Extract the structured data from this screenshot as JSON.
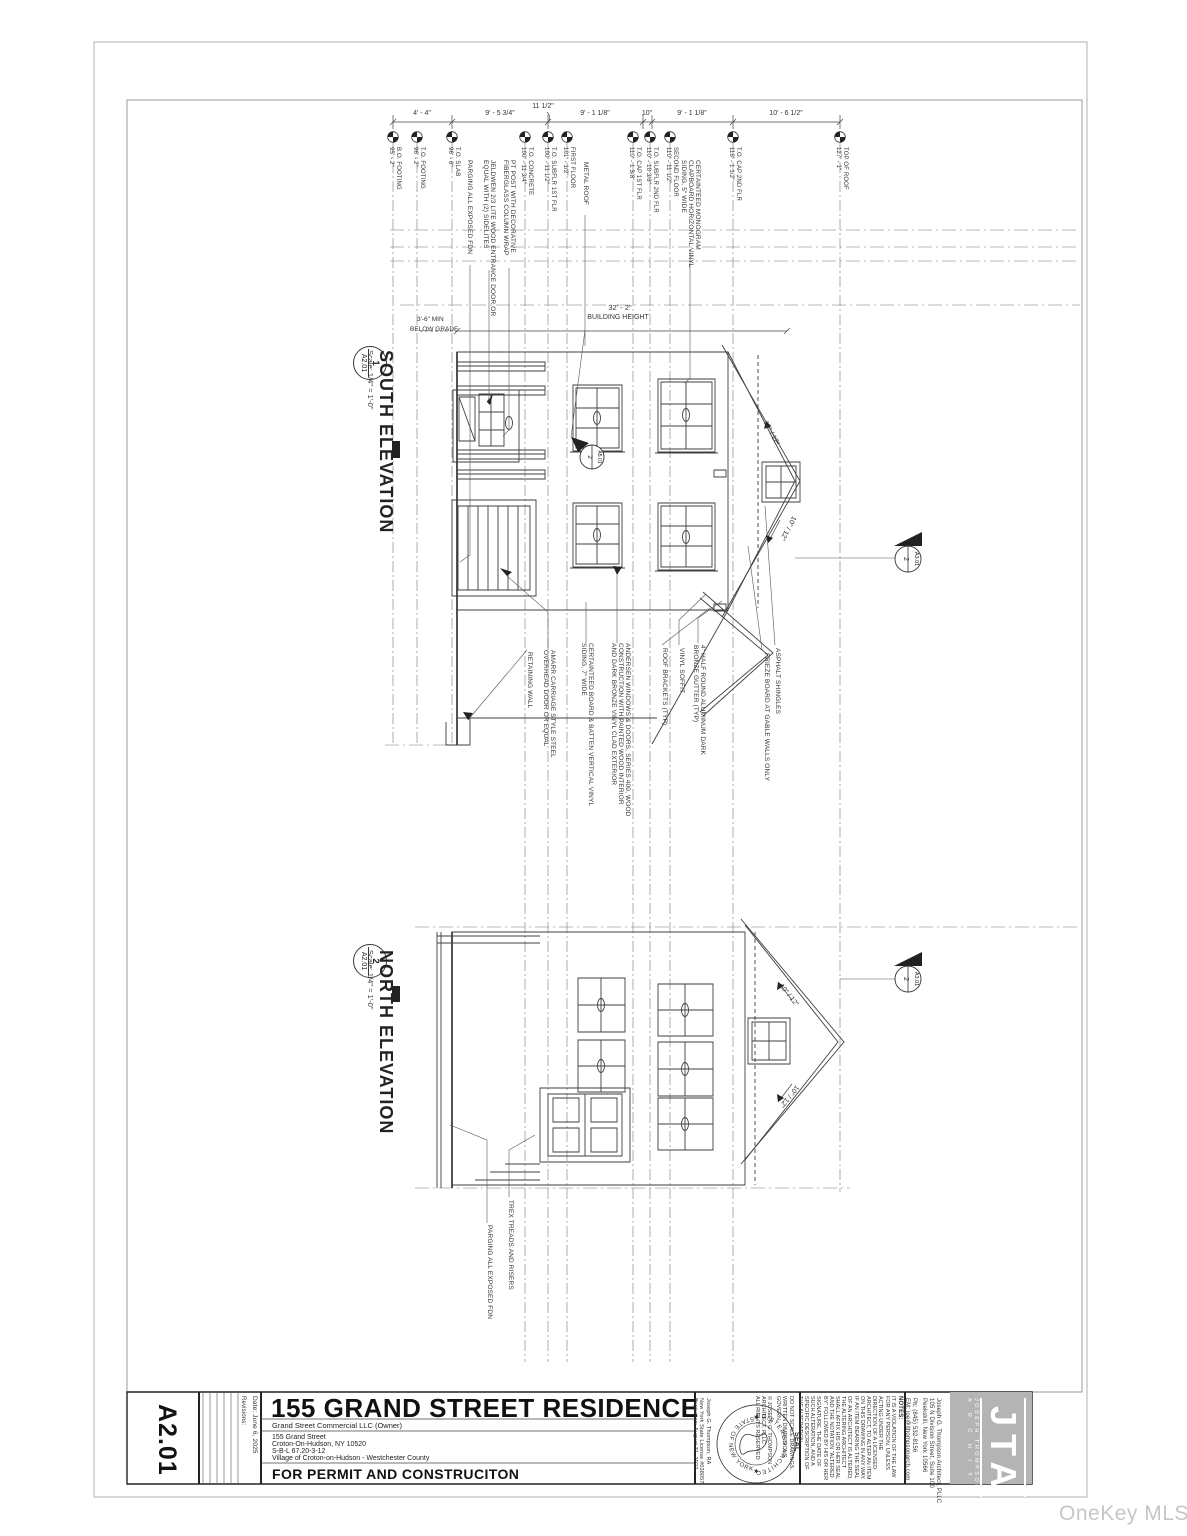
{
  "watermark": "OneKey MLS",
  "titleblock": {
    "sheet_number": "A2.01",
    "revisions_label": "Revisions:",
    "date_line": "Date: June 6, 2025",
    "project_title": "155 GRAND STREET RESIDENCE",
    "owner_line": "Grand Street Commercial LLC (Owner)",
    "address_line1": "155 Grand Street",
    "address_line2": "Croton-On-Hudson, NY 10520",
    "address_line3": "S-B-L 67.20-3-12",
    "address_line4": "Village of Croton-on-Hudson - Westchester County",
    "status_line": "FOR PERMIT AND CONSTRUCITON",
    "notes_label": "NOTES:",
    "notes_body": "IT IS A VIOLATION OF THE LAW FOR ANY PERSON, UNLESS ACTING UNDER THE DIRECTION OF A LICENSED ARCHITECT, TO ALTER AN ITEM ON THIS DRAWING IN ANY WAY. IF AN ITEM BEARING THE SEAL OF AN ARCHITECT IS ALTERED, THE ALTERING ARCHITECT SHALL AFFIX HIS OR HER SEAL AND THE NOTATION \"ALTERED BY\" FOLLOWED BY HIS OR HER SIGNATURE, THE DATE OF SUCH ALTERATION, AND A SPECIFIC DESCRIPTION OF THE ALTERATION.",
    "do_not_scale_1": "DO NOT SCALE DRAWINGS.",
    "do_not_scale_2": "WRITTEN DIMENSIONS GOVERN.",
    "copyright_1": "© JOSEPH G. THOMPSON ARCHITECT, PLLC",
    "copyright_2": "ALL RIGHTS RESERVED",
    "seal_label": "SEAL",
    "seal_ring_top": "REGISTERED ARCHITECT",
    "seal_ring_bottom": "STATE OF NEW YORK",
    "license_line1": "Joseph G. Thompson, RA",
    "license_line2": "New York State License #038057",
    "license_line3": "Expiration: August 31, 2027",
    "architect_line1": "Joseph G. Thompson Architect, PLLC",
    "architect_line2": "105 N Division Street, Suite 100",
    "architect_line3": "Peekskill, New York 10566",
    "architect_line4": "Ph: (845) 532-8156",
    "architect_line5": "EM: joe@jthompsonarch.com",
    "logo_initials": "JTA",
    "logo_name_line1": "JOSEPH THOMPSON",
    "logo_name_line2": "A R C H I T E C T"
  },
  "views": {
    "south": {
      "number": "1",
      "sheet": "A2.01",
      "title": "SOUTH ELEVATION",
      "scale": "Scale:  1/4\" = 1'-0\""
    },
    "north": {
      "number": "2",
      "sheet": "A2.01",
      "title": "NORTH ELEVATION",
      "scale": "Scale:  1/4\" = 1'-0\""
    }
  },
  "dims": {
    "d1": "4' - 4\"",
    "d2": "9' - 5 3/4\"",
    "d3": "11 1/2\"",
    "d4": "9' - 1 1/8\"",
    "d5": "10\"",
    "d6": "9' - 1 1/8\"",
    "d7": "10' - 6 1/2\"",
    "building_height_dim": "32' - 2\"",
    "building_height_label": "BUILDING HEIGHT",
    "below_grade_line1": "3'-6\" MIN",
    "below_grade_line2": "BELOW GRADE",
    "pitch": "10\" / 12\""
  },
  "levels": [
    {
      "label": "B.O. FOOTING",
      "value": "95' - 2\""
    },
    {
      "label": "T.O. FOOTING",
      "value": "96' - 2\""
    },
    {
      "label": "T.O. SLAB",
      "value": "96' - 6\""
    },
    {
      "label": "T.O. CONCRETE",
      "value": "100' - 11 3/4\""
    },
    {
      "label": "T.O. SUBFLR 1ST FLR",
      "value": "100' - 11 1/2\""
    },
    {
      "label": "FIRST FLOOR",
      "value": "101' - 1/2\""
    },
    {
      "label": "T.O. CAP 1ST FLR",
      "value": "110' - 1 3/8\""
    },
    {
      "label": "T.O. SUBFLR 2ND FLR",
      "value": "110' - 10 3/8\""
    },
    {
      "label": "SECOND FLOOR",
      "value": "110' - 11 1/2\""
    },
    {
      "label": "T.O. CAP 2ND FLR",
      "value": "118' - 1 1/2\""
    },
    {
      "label": "TOP OF ROOF",
      "value": "127' - 1\""
    }
  ],
  "notes_top": [
    {
      "l1": "PARGING ALL EXPOSED FDN",
      "l2": "",
      "l3": ""
    },
    {
      "l1": "JELDWEN 2/3 LITE WOOD ENTRANCE DOOR OR",
      "l2": "EQUAL WITH (2) SIDELITES",
      "l3": ""
    },
    {
      "l1": "PT POST WITH DECORATIVE",
      "l2": "FIBERGLASS COLUMN WRAP",
      "l3": ""
    },
    {
      "l1": "METAL ROOF",
      "l2": "",
      "l3": ""
    },
    {
      "l1": "CERTAINTEED MONOGRAM",
      "l2": "CLAPBOARD HORIZONTAL VINYL",
      "l3": "SIDING, 5\" WIDE"
    }
  ],
  "notes_south": [
    {
      "l1": "RETAINING WALL",
      "l2": "",
      "l3": ""
    },
    {
      "l1": "AMARR CARRIAGE STYLE STEEL",
      "l2": "OVERHEAD DOOR OR EQUAL",
      "l3": ""
    },
    {
      "l1": "CERTAINTEED BOARD & BATTEN VERTICAL VINYL",
      "l2": "SIDING, 7\" WIDE",
      "l3": ""
    },
    {
      "l1": "ANDERSEN WINDOWS & DOORS, SERIES 400, WOOD",
      "l2": "CONSTRUCTION WITH PAINTED WOOD INTERIOR",
      "l3": "AND DARK BRONZE VINYL CLAD EXTERIOR"
    },
    {
      "l1": "ROOF BRACKETS (TYP)",
      "l2": "",
      "l3": ""
    },
    {
      "l1": "VINYL SOFFIT",
      "l2": "",
      "l3": ""
    },
    {
      "l1": "4\" HALF ROUND ALUMINUM DARK",
      "l2": "BRONZE GUTTER (TYP)",
      "l3": ""
    },
    {
      "l1": "FRIEZE BOARD AT GABLE WALLS ONLY",
      "l2": "",
      "l3": ""
    },
    {
      "l1": "ASPHALT SHINGLES",
      "l2": "",
      "l3": ""
    }
  ],
  "notes_north": [
    {
      "l1": "TREX TREADS AND RISERS"
    },
    {
      "l1": "PARGING ALL EXPOSED FDN"
    }
  ],
  "callouts": {
    "section_south": {
      "number": "2",
      "sheet": "A3.01"
    },
    "section_north": {
      "number": "2",
      "sheet": "A3.01"
    },
    "detail_south": {
      "number": "2",
      "sheet": "A5.01"
    }
  }
}
